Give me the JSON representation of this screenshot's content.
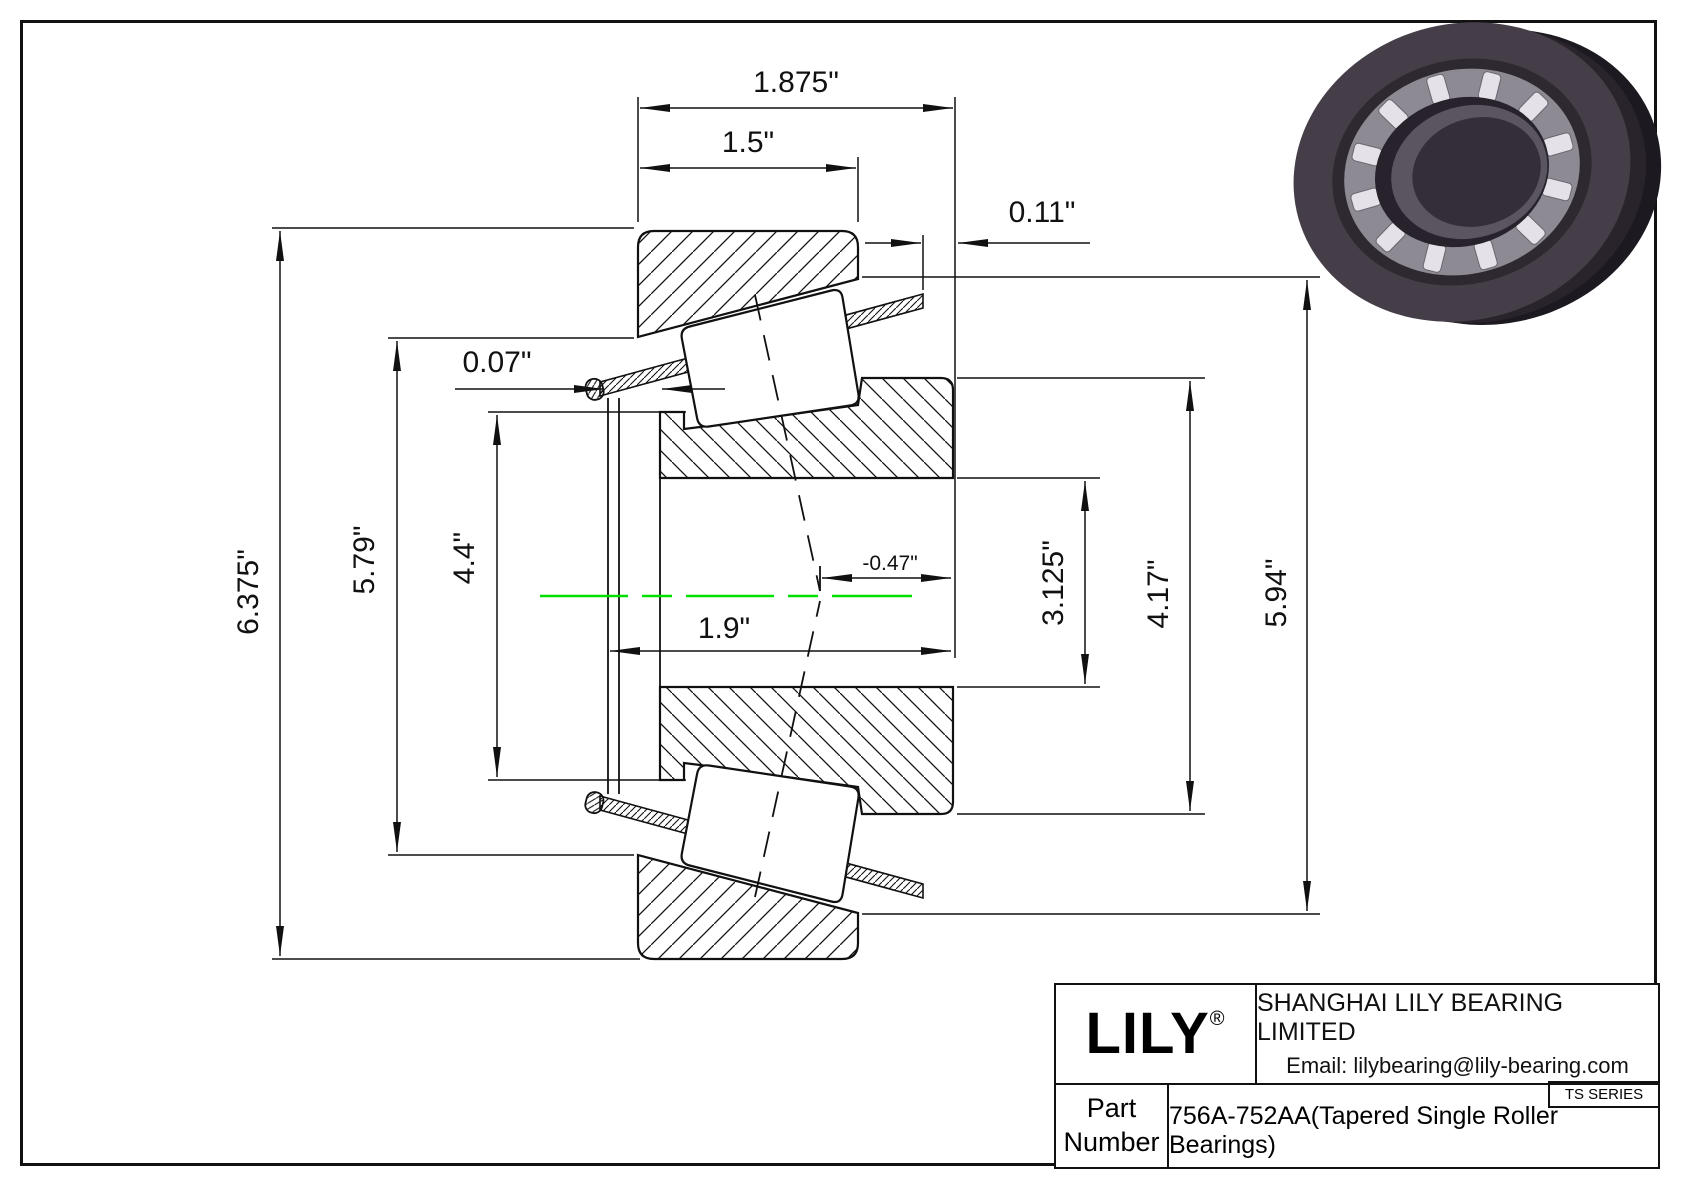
{
  "drawing": {
    "dim_labels": {
      "total_width": "1.875\"",
      "cup_width": "1.5\"",
      "cage_protrusion": "0.11\"",
      "cage_lip": "0.07\"",
      "outer_diameter": "6.375\"",
      "cage_outer_diameter": "5.79\"",
      "cone_step_diameter": "4.4\"",
      "cone_width": "1.9\"",
      "effective_center": "-0.47\"",
      "bore_diameter": "3.125\"",
      "cone_rib_diameter": "4.17\"",
      "cup_race_diameter": "5.94\""
    },
    "centerline_color": "#00e000"
  },
  "title_block": {
    "brand": "LILY",
    "registered_mark": "®",
    "company": "SHANGHAI LILY BEARING LIMITED",
    "email": "Email: lilybearing@lily-bearing.com",
    "series_badge": "TS SERIES",
    "part_label_line1": "Part",
    "part_label_line2": "Number",
    "part_number": "756A-752AA(Tapered Single Roller Bearings)"
  }
}
